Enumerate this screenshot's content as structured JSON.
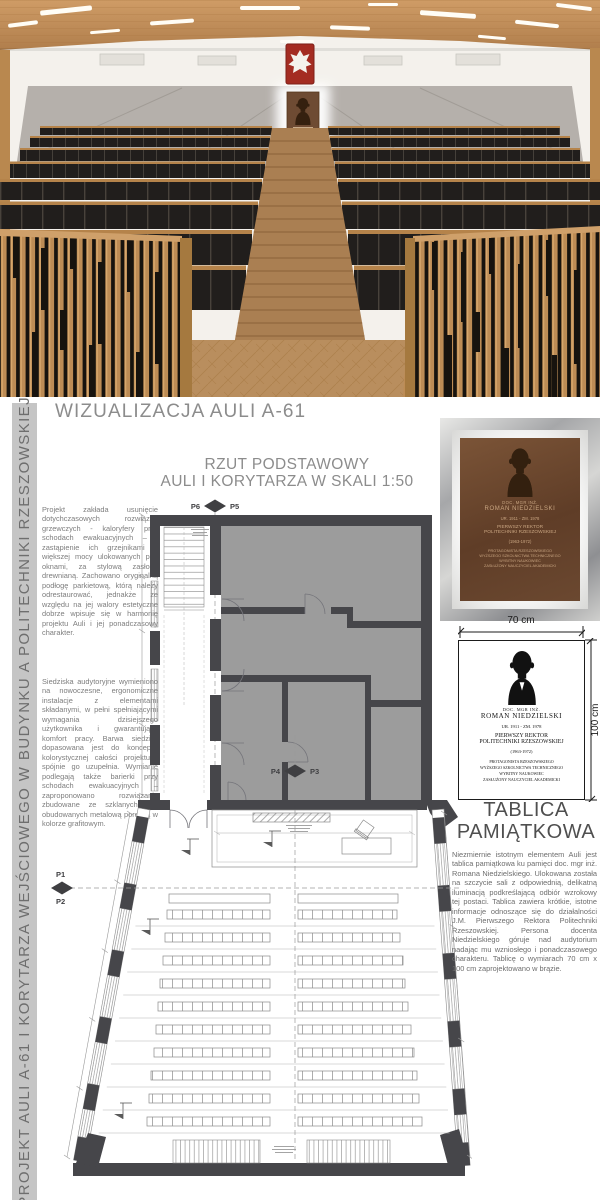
{
  "colors": {
    "accent-red": "#a42c22",
    "wood": "#b9884f",
    "seat-dark": "#211e1c",
    "plaque-brown": "#5f3d27",
    "wall-grey": "#b5b0ab",
    "plan-wall": "#46464a",
    "text-grey": "#7d7d7d"
  },
  "board": {
    "side_title": "PROJEKT AULI A-61 I KORYTARZA WEJŚCIOWEGO W BUDYNKU A POLITECHNIKI RZESZOWSKIEJ",
    "visualization_title": "WIZUALIZACJA AULI A-61"
  },
  "left_column": {
    "paragraph1": "Projekt zakłada usunięcie dotychczasowych rozwiązań grzewczych - kaloryfery przy schodach ewakuacyjnych – i zastąpienie ich grzejnikami o większej mocy ulokowanych pod oknami, za stylową zasłoną drewnianą. Zachowano oryginalną podłogę parkietową, którą należy odrestaurować, jednakże ze względu na jej walory estetyczne dobrze wpisuje się w harmonię projektu Auli i jej ponadczasowy charakter.",
    "paragraph2": "Siedziska audytoryjne wymieniono na nowoczesne, ergonomiczne instalacje z elementami składanymi, w pełni spełniającymi wymagania dzisiejszego użytkownika i gwarantujące komfort pracy. Barwa siedzisk dopasowana jest do koncepcji kolorystycznej całości projektu i spójnie go uzupełnia. Wymianie podlegają także barierki przy schodach ewakuacyjnych – zaproponowano rozwiązanie zbudowane ze szklanych tafli obudowanych metalową poręczą w kolorze grafitowym."
  },
  "plan": {
    "title_line1": "RZUT PODSTAWOWY",
    "title_line2": "AULI I KORYTARZA W SKALI 1:50",
    "markers": {
      "p1": "P1",
      "p2": "P2",
      "p3": "P3",
      "p4": "P4",
      "p5": "P5",
      "p6": "P6"
    }
  },
  "plaque": {
    "dimensions": {
      "width": "70 cm",
      "height": "100 cm"
    },
    "lines": {
      "pretitle": "DOC. MGR INŻ.",
      "name": "ROMAN NIEDZIELSKI",
      "dates": "UR. 1911 - ZM. 1978",
      "role1": "PIERWSZY REKTOR",
      "role2": "POLITECHNIKI RZESZOWSKIEJ",
      "tenure": "(1963-1972)",
      "desc1": "PROTAGONISTA RZESZOWSKIEGO",
      "desc2": "WYŻSZEGO SZKOLNICTWA TECHNICZNEGO",
      "desc3": "WYBITNY NAUKOWIEC",
      "desc4": "ZASŁUŻONY NAUCZYCIEL AKADEMICKI"
    },
    "section_heading": "TABLICA PAMIĄTKOWA",
    "paragraph": "Niezmiernie istotnym elementem Auli jest tablica pamiątkowa ku pamięci doc. mgr inż. Romana Niedzielskiego. Ulokowana została na szczycie sali z odpowiednią, delikatną iluminacją podkreślającą odbiór wzrokowy tej postaci. Tablica zawiera krótkie, istotne informacje odnoszące się do działalności J.M. Pierwszego Rektora Politechniki Rzeszowskiej. Persona docenta Niedzielskiego góruje nad audytorium nadając mu wzniosłego i ponadczasowego charakteru. Tablicę o wymiarach 70 cm x 100 cm zaprojektowano w brązie."
  }
}
